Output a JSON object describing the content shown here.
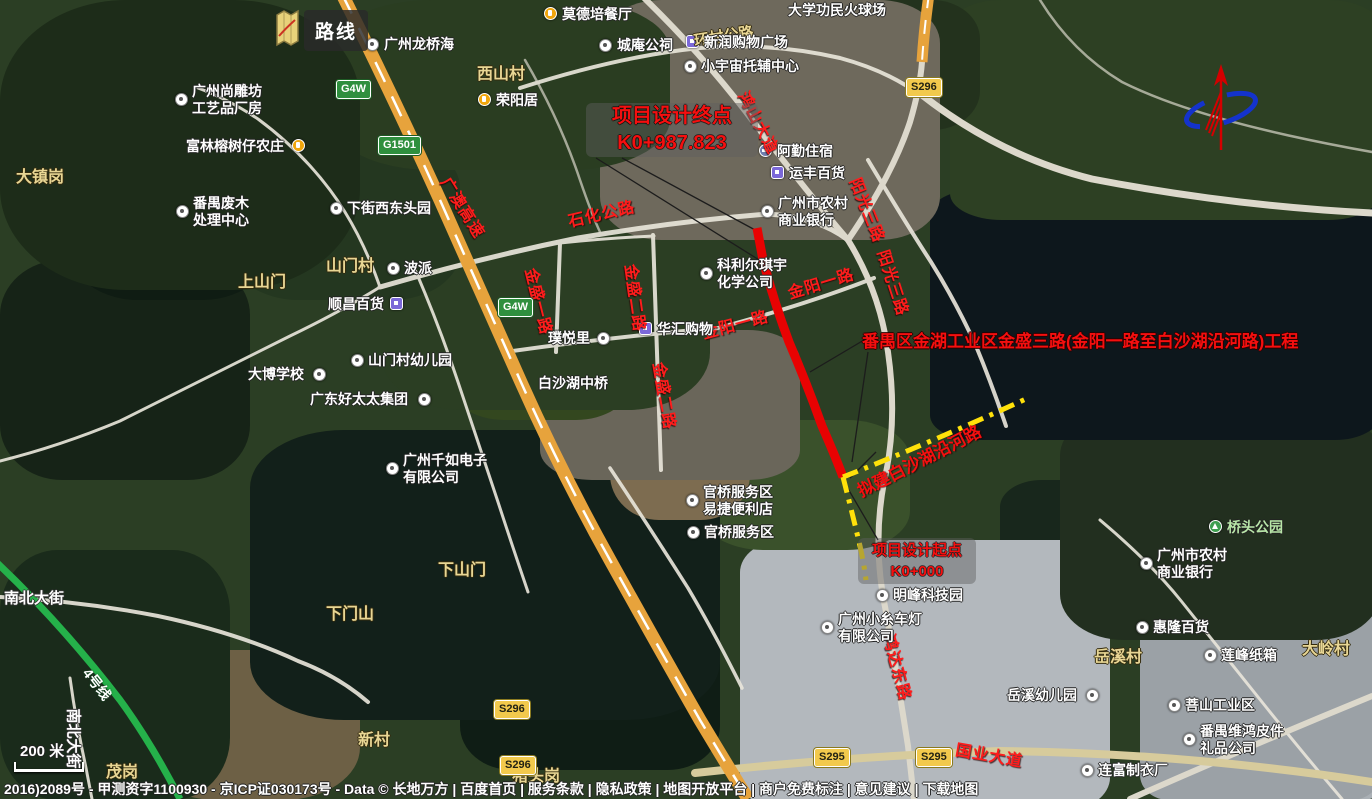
{
  "legend": {
    "label": "路线"
  },
  "scale_bar": {
    "label": "200 米"
  },
  "metro": {
    "label": "4号线"
  },
  "attribution": {
    "text": "2016)2089号 - 甲测资字1100930 - 京ICP证030173号 - Data © 长地万方 | 百度首页 | 服务条款 | 隐私政策 | 地图开放平台 | 商户免费标注 | 意见建议 | 下载地图"
  },
  "project": {
    "title": "番禺区金湖工业区金盛三路(金阳一路至白沙湖沿河路)工程",
    "end_point": {
      "label": "项目设计终点",
      "chainage": "K0+987.823"
    },
    "start_point": {
      "label": "项目设计起点",
      "chainage": "K0+000"
    },
    "planned_road": {
      "label": "拟建白沙湖沿河路"
    }
  },
  "icons": {
    "north": "north-arrow",
    "legend": "route-map-icon"
  },
  "colors": {
    "project_road": "#e80202",
    "planned_road": "#ffe10a",
    "metro": "#25b14a",
    "expressway": "#e7a33c",
    "annotation_red": "#f50f0f"
  },
  "road_badges": [
    {
      "text": "G4W",
      "kind": "hw",
      "x": 336,
      "y": 80
    },
    {
      "text": "G1501",
      "kind": "hw",
      "x": 378,
      "y": 136
    },
    {
      "text": "G4W",
      "kind": "hw",
      "x": 498,
      "y": 298
    },
    {
      "text": "S296",
      "kind": "prov",
      "x": 906,
      "y": 78
    },
    {
      "text": "S296",
      "kind": "prov",
      "x": 494,
      "y": 700
    },
    {
      "text": "S296",
      "kind": "prov",
      "x": 500,
      "y": 756
    },
    {
      "text": "S295",
      "kind": "prov",
      "x": 814,
      "y": 748
    },
    {
      "text": "S295",
      "kind": "prov",
      "x": 916,
      "y": 748
    }
  ],
  "red_road_labels": [
    {
      "text": "广澳高速",
      "x": 446,
      "y": 166,
      "rot": 58
    },
    {
      "text": "石化公路",
      "x": 568,
      "y": 208,
      "rot": -13
    },
    {
      "text": "鸿山大道",
      "x": 744,
      "y": 80,
      "rot": 62
    },
    {
      "text": "金盛一路",
      "x": 532,
      "y": 256,
      "rot": 76
    },
    {
      "text": "金盛二路",
      "x": 632,
      "y": 252,
      "rot": 82
    },
    {
      "text": "金盛二路",
      "x": 660,
      "y": 350,
      "rot": 80
    },
    {
      "text": "金阳一路",
      "x": 702,
      "y": 320,
      "rot": -15
    },
    {
      "text": "金阳一路",
      "x": 788,
      "y": 280,
      "rot": -17
    },
    {
      "text": "阳光三路",
      "x": 856,
      "y": 166,
      "rot": 68
    },
    {
      "text": "阳光三路",
      "x": 884,
      "y": 238,
      "rot": 72
    },
    {
      "text": "鸿达东路",
      "x": 890,
      "y": 622,
      "rot": 75
    },
    {
      "text": "国业大道",
      "x": 956,
      "y": 736,
      "rot": 10
    }
  ],
  "map_road_labels": [
    {
      "text": "环村公路",
      "x": 694,
      "y": 30,
      "rot": -9,
      "style": "khaki"
    },
    {
      "text": "南北大街",
      "x": 4,
      "y": 587,
      "rot": 0,
      "style": "white"
    },
    {
      "text": "南北大街",
      "x": 74,
      "y": 698,
      "rot": 90,
      "style": "white"
    }
  ],
  "village_labels": [
    {
      "text": "大镇岗",
      "x": 16,
      "y": 163
    },
    {
      "text": "西山村",
      "x": 477,
      "y": 60
    },
    {
      "text": "山门村",
      "x": 326,
      "y": 252
    },
    {
      "text": "上山门",
      "x": 238,
      "y": 268
    },
    {
      "text": "下山门",
      "x": 438,
      "y": 556
    },
    {
      "text": "下门山",
      "x": 326,
      "y": 600
    },
    {
      "text": "新村",
      "x": 358,
      "y": 726
    },
    {
      "text": "猪头岗",
      "x": 512,
      "y": 762
    },
    {
      "text": "茂岗",
      "x": 106,
      "y": 758
    },
    {
      "text": "岳溪村",
      "x": 1094,
      "y": 643
    },
    {
      "text": "大岭村",
      "x": 1302,
      "y": 635
    }
  ],
  "pois": [
    {
      "lines": [
        "莫德培餐厅"
      ],
      "x": 562,
      "y": 6,
      "icon": "food",
      "ix": 544,
      "iy": 7
    },
    {
      "lines": [
        "大学功民火球场"
      ],
      "x": 788,
      "y": 2,
      "icon": "none"
    },
    {
      "lines": [
        "广州龙桥海"
      ],
      "x": 384,
      "y": 36,
      "icon": "dot",
      "ix": 366,
      "iy": 38
    },
    {
      "lines": [
        "城庵公祠"
      ],
      "x": 617,
      "y": 37,
      "icon": "dot",
      "ix": 599,
      "iy": 39
    },
    {
      "lines": [
        "新润购物广场"
      ],
      "x": 704,
      "y": 34,
      "icon": "shop",
      "ix": 686,
      "iy": 35
    },
    {
      "lines": [
        "小宇宙托辅中心"
      ],
      "x": 701,
      "y": 58,
      "icon": "dot",
      "ix": 684,
      "iy": 60
    },
    {
      "lines": [
        "荣阳居"
      ],
      "x": 496,
      "y": 92,
      "icon": "food",
      "ix": 478,
      "iy": 93
    },
    {
      "lines": [
        "阿勤住宿"
      ],
      "x": 777,
      "y": 143,
      "icon": "hotel",
      "ix": 759,
      "iy": 144
    },
    {
      "lines": [
        "运丰百货"
      ],
      "x": 789,
      "y": 165,
      "icon": "shop",
      "ix": 771,
      "iy": 166
    },
    {
      "lines": [
        "广州市农村",
        "商业银行"
      ],
      "x": 778,
      "y": 195,
      "icon": "dot",
      "ix": 761,
      "iy": 205
    },
    {
      "lines": [
        "广州尚雕坊",
        "工艺品厂房"
      ],
      "x": 192,
      "y": 83,
      "icon": "dot",
      "ix": 175,
      "iy": 93
    },
    {
      "lines": [
        "富林榕树仔农庄"
      ],
      "x": 186,
      "y": 138,
      "icon": "food",
      "ix": 292,
      "iy": 139
    },
    {
      "lines": [
        "番禺废木",
        "处理中心"
      ],
      "x": 193,
      "y": 195,
      "icon": "dot",
      "ix": 176,
      "iy": 205
    },
    {
      "lines": [
        "下街西东头园"
      ],
      "x": 347,
      "y": 200,
      "icon": "dot",
      "ix": 330,
      "iy": 202
    },
    {
      "lines": [
        "波派"
      ],
      "x": 404,
      "y": 260,
      "icon": "dot",
      "ix": 387,
      "iy": 262
    },
    {
      "lines": [
        "顺昌百货"
      ],
      "x": 328,
      "y": 296,
      "icon": "shop",
      "ix": 390,
      "iy": 297
    },
    {
      "lines": [
        "山门村幼儿园"
      ],
      "x": 368,
      "y": 352,
      "icon": "dot",
      "ix": 351,
      "iy": 354
    },
    {
      "lines": [
        "大博学校"
      ],
      "x": 248,
      "y": 366,
      "icon": "dot",
      "ix": 313,
      "iy": 368
    },
    {
      "lines": [
        "广东好太太集团"
      ],
      "x": 310,
      "y": 391,
      "icon": "dot",
      "ix": 418,
      "iy": 393
    },
    {
      "lines": [
        "广州千如电子",
        "有限公司"
      ],
      "x": 403,
      "y": 452,
      "icon": "dot",
      "ix": 386,
      "iy": 462
    },
    {
      "lines": [
        "璞悦里"
      ],
      "x": 548,
      "y": 330,
      "icon": "dot",
      "ix": 597,
      "iy": 332
    },
    {
      "lines": [
        "华汇购物"
      ],
      "x": 657,
      "y": 321,
      "icon": "shop",
      "ix": 639,
      "iy": 322
    },
    {
      "lines": [
        "科利尔琪宇",
        "化学公司"
      ],
      "x": 717,
      "y": 257,
      "icon": "dot",
      "ix": 700,
      "iy": 267
    },
    {
      "lines": [
        "白沙湖中桥"
      ],
      "x": 538,
      "y": 375,
      "icon": "none"
    },
    {
      "lines": [
        "官桥服务区",
        "易捷便利店"
      ],
      "x": 703,
      "y": 484,
      "icon": "dot",
      "ix": 686,
      "iy": 494
    },
    {
      "lines": [
        "官桥服务区"
      ],
      "x": 704,
      "y": 524,
      "icon": "dot",
      "ix": 687,
      "iy": 526
    },
    {
      "lines": [
        "明峰科技园"
      ],
      "x": 893,
      "y": 587,
      "icon": "dot",
      "ix": 876,
      "iy": 589
    },
    {
      "lines": [
        "广州小糸车灯",
        "有限公司"
      ],
      "x": 838,
      "y": 611,
      "icon": "dot",
      "ix": 821,
      "iy": 621
    },
    {
      "lines": [
        "岳溪幼儿园"
      ],
      "x": 1007,
      "y": 687,
      "icon": "dot",
      "ix": 1086,
      "iy": 689
    },
    {
      "lines": [
        "桥头公园"
      ],
      "x": 1227,
      "y": 519,
      "icon": "park",
      "ix": 1209,
      "iy": 520,
      "color": "#b8e6a8"
    },
    {
      "lines": [
        "广州市农村",
        "商业银行"
      ],
      "x": 1157,
      "y": 547,
      "icon": "dot",
      "ix": 1140,
      "iy": 557
    },
    {
      "lines": [
        "惠隆百货"
      ],
      "x": 1153,
      "y": 619,
      "icon": "dot",
      "ix": 1136,
      "iy": 621
    },
    {
      "lines": [
        "莲峰纸箱"
      ],
      "x": 1221,
      "y": 647,
      "icon": "dot",
      "ix": 1204,
      "iy": 649
    },
    {
      "lines": [
        "菩山工业区"
      ],
      "x": 1185,
      "y": 697,
      "icon": "dot",
      "ix": 1168,
      "iy": 699
    },
    {
      "lines": [
        "番禺维鸿皮件",
        "礼品公司"
      ],
      "x": 1200,
      "y": 723,
      "icon": "dot",
      "ix": 1183,
      "iy": 733
    },
    {
      "lines": [
        "连富制衣厂"
      ],
      "x": 1098,
      "y": 762,
      "icon": "dot",
      "ix": 1081,
      "iy": 764
    }
  ]
}
